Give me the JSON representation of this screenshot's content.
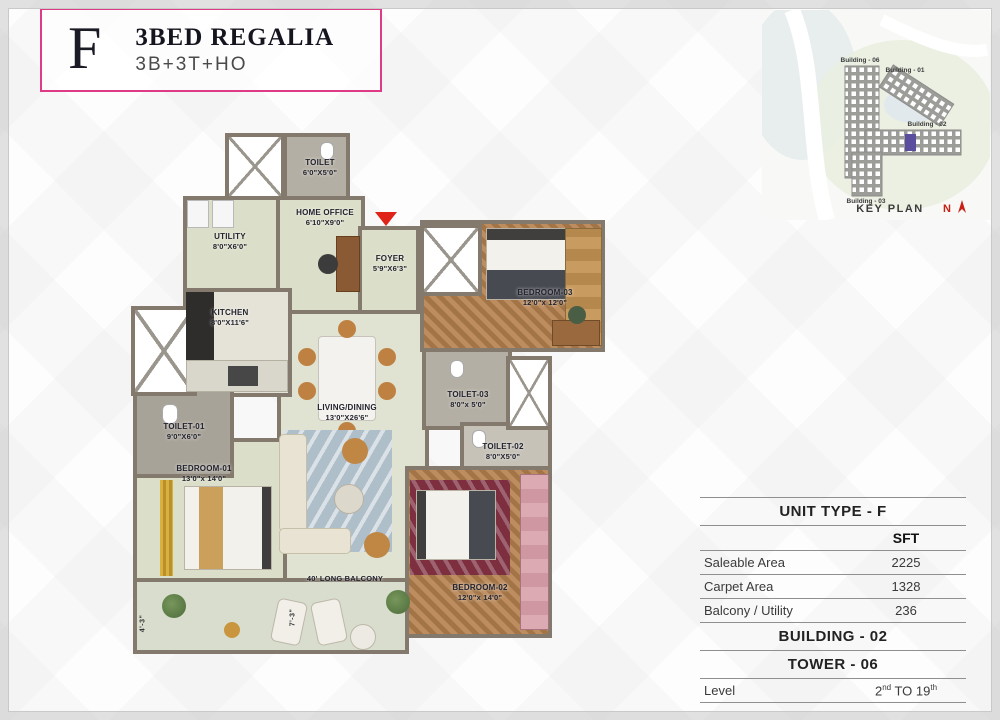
{
  "header": {
    "unit_letter": "F",
    "title": "3BED REGALIA",
    "subtitle": "3B+3T+HO",
    "accent_color": "#de3a86"
  },
  "key_plan": {
    "label": "KEY PLAN",
    "north_label": "N",
    "highlight_color": "#5c4e9e",
    "buildings": [
      {
        "label": "Building - 06"
      },
      {
        "label": "Building - 01"
      },
      {
        "label": "Building - 02"
      },
      {
        "label": "Building - 03"
      }
    ]
  },
  "plan": {
    "entry_marker_color": "#df2318",
    "balcony_label": "40' LONG BALCONY",
    "dimensions": [
      "4'-3\"",
      "7'-3\""
    ],
    "rooms": [
      {
        "name": "TOILET",
        "dim": "6'0\"X5'0\""
      },
      {
        "name": "HOME OFFICE",
        "dim": "6'10\"X9'0\""
      },
      {
        "name": "UTILITY",
        "dim": "8'0\"X6'0\""
      },
      {
        "name": "KITCHEN",
        "dim": "8'0\"X11'6\""
      },
      {
        "name": "FOYER",
        "dim": "5'9\"X6'3\""
      },
      {
        "name": "BEDROOM-03",
        "dim": "12'0\"x 12'0\""
      },
      {
        "name": "TOILET-03",
        "dim": "8'0\"x 5'0\""
      },
      {
        "name": "TOILET-02",
        "dim": "8'0\"X5'0\""
      },
      {
        "name": "TOILET-01",
        "dim": "9'0\"X6'0\""
      },
      {
        "name": "BEDROOM-01",
        "dim": "13'0\"x 14'0\""
      },
      {
        "name": "LIVING/DINING",
        "dim": "13'0\"X26'6\""
      },
      {
        "name": "BEDROOM-02",
        "dim": "12'0\"x 14'0\""
      }
    ]
  },
  "unit_table": {
    "title": "UNIT TYPE - F",
    "unit_header": "SFT",
    "rows": [
      {
        "label": "Saleable Area",
        "value": "2225"
      },
      {
        "label": "Carpet Area",
        "value": "1328"
      },
      {
        "label": "Balcony / Utility",
        "value": "236"
      }
    ],
    "building": "BUILDING - 02",
    "tower": "TOWER - 06",
    "level_label": "Level",
    "level_value": {
      "b1": "2",
      "s1": "nd",
      "b2": " TO 19",
      "s2": "th"
    }
  }
}
